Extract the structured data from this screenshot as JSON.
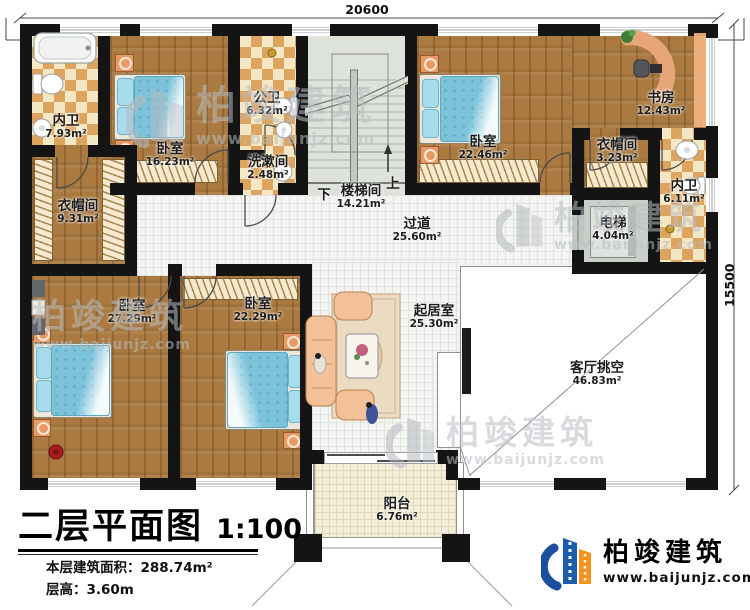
{
  "title_block": {
    "title": "二层平面图",
    "scale": "1:100",
    "floor_area": "本层建筑面积：288.74m²",
    "floor_height": "层高：3.60m"
  },
  "dimensions": {
    "top": "20600",
    "right": "15500"
  },
  "stairs": {
    "down": "下",
    "up": "上"
  },
  "brand": {
    "name": "柏竣建筑",
    "website": "www.baijunjz.com"
  },
  "watermark": {
    "name": "柏竣建筑",
    "website": "www.baijunjz.com"
  },
  "rooms": [
    {
      "id": "bath-top-left",
      "name": "内卫",
      "area": "7.93m²"
    },
    {
      "id": "bedroom-top-left",
      "name": "卧室",
      "area": "16.23m²"
    },
    {
      "id": "public-bath",
      "name": "公卫",
      "area": "6.32m²"
    },
    {
      "id": "wash-room",
      "name": "洗漱间",
      "area": "2.48m²"
    },
    {
      "id": "stairwell",
      "name": "楼梯间",
      "area": "14.21m²"
    },
    {
      "id": "bedroom-top-right",
      "name": "卧室",
      "area": "22.46m²"
    },
    {
      "id": "study",
      "name": "书房",
      "area": "12.43m²"
    },
    {
      "id": "closet-right",
      "name": "衣帽间",
      "area": "3.23m²"
    },
    {
      "id": "bath-right",
      "name": "内卫",
      "area": "6.11m²"
    },
    {
      "id": "elevator",
      "name": "电梯",
      "area": "4.04m²"
    },
    {
      "id": "closet-left",
      "name": "衣帽间",
      "area": "9.31m²"
    },
    {
      "id": "corridor",
      "name": "过道",
      "area": "25.60m²"
    },
    {
      "id": "bedroom-bottom-left",
      "name": "卧室",
      "area": "27.29m²"
    },
    {
      "id": "bedroom-bottom-mid",
      "name": "卧室",
      "area": "22.29m²"
    },
    {
      "id": "living-room",
      "name": "起居室",
      "area": "25.30m²"
    },
    {
      "id": "living-void",
      "name": "客厅挑空",
      "area": "46.83m²"
    },
    {
      "id": "balcony",
      "name": "阳台",
      "area": "6.76m²"
    }
  ]
}
